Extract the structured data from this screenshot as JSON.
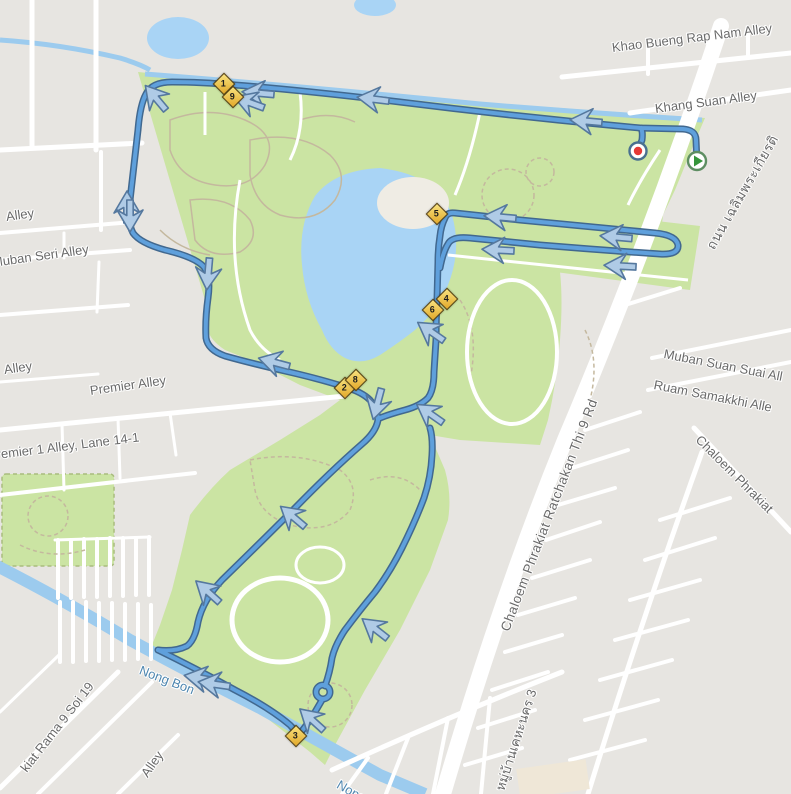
{
  "map_labels": {
    "khao_bueng": "Khao Bueng Rap Nam Alley",
    "khang_suan": "Khang Suan Alley",
    "alley_top_left": "Alley",
    "muban_seri": "Muban Seri Alley",
    "alley_mid_left": "Alley",
    "premier_alley": "Premier Alley",
    "premier1": "Premier 1 Alley, Lane 14-1",
    "muban_suan_suai": "Muban Suan Suai All",
    "ruam_samakkhi": "Ruam Samakkhi Alle",
    "chaloem_partial": "Chaloem Phrakiat",
    "main_road": "Chaloem Phrakiat Ratchakan Thi 9 Rd",
    "main_road_thai": "ถนน เฉลิมพระเกียรติ",
    "nong_bon": "Nong Bon",
    "nong_partial": "Nong",
    "rama9_soi19": "kiat Rama 9 Soi 19",
    "alley_bottom": "Alley",
    "thai_bottom": "หมู่บ้านเคหะนคร 3"
  },
  "route_markers": {
    "km": [
      "1",
      "9",
      "2",
      "8",
      "5",
      "4",
      "6",
      "3"
    ],
    "start_label": "route-start",
    "finish_label": "route-finish"
  },
  "colors": {
    "bg": "#E7E5E1",
    "road": "#FFFFFF",
    "park": "#CBE4A3",
    "water": "#9CCBEE",
    "lake": "#A9D4F5",
    "island": "#EFECE4",
    "route_casing": "#41688F",
    "route_fill": "#5FA0DC",
    "arrow_fill": "#AFCBE6",
    "arrow_stroke": "#55789E",
    "km_fill_a": "#F8E27E",
    "km_fill_b": "#E2A82A",
    "km_border": "#5A430F",
    "label": "#6A6A6A",
    "water_label": "#4E86AF",
    "start_green": "#35953B",
    "finish_red": "#E53935",
    "marker_ring": "#49708F",
    "path_tan": "#C4B89E",
    "beige": "#EFE7D7",
    "park_border": "#A9BC7E"
  }
}
